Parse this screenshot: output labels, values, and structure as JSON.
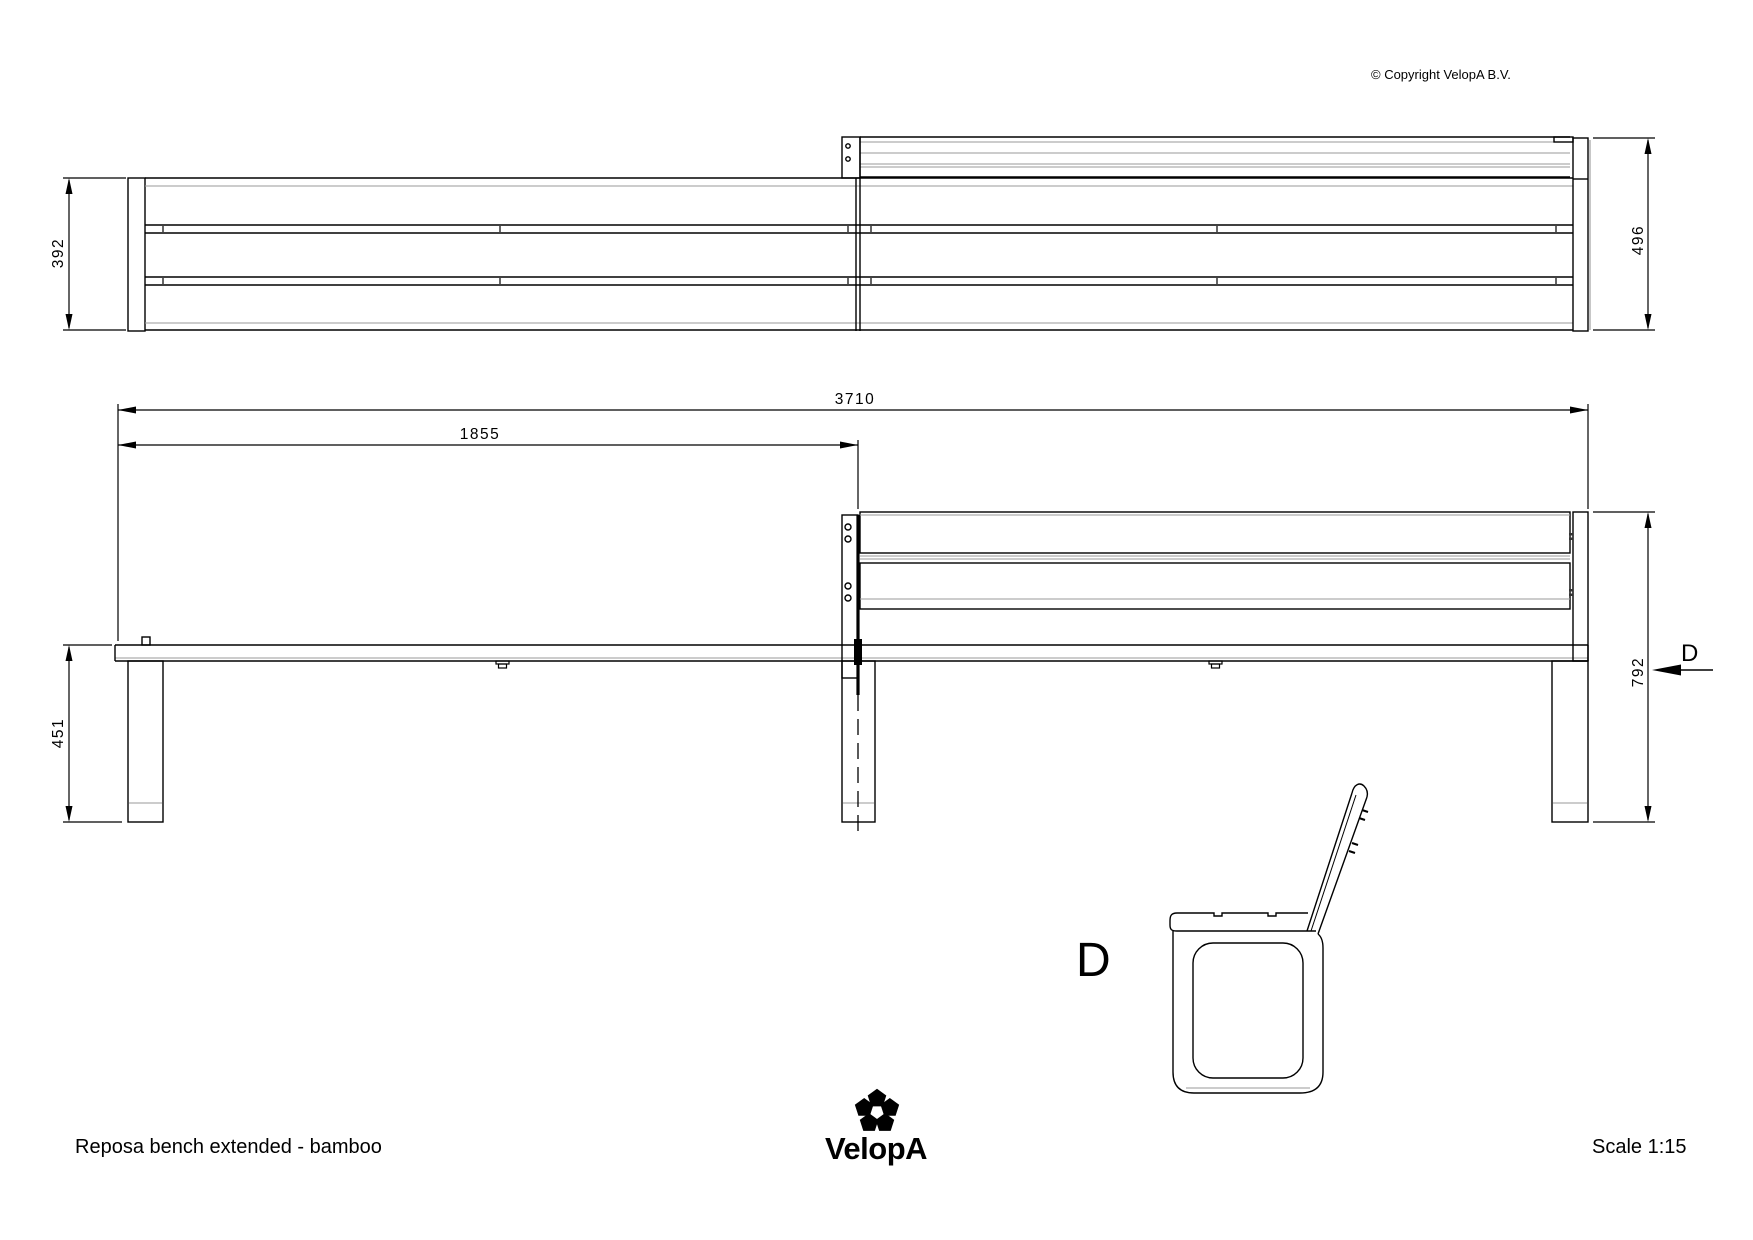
{
  "labels": {
    "drawing_title": "Reposa bench extended - bamboo",
    "scale": "Scale 1:15",
    "copyright": "©  Copyright VelopA B.V.",
    "brand": "VelopA",
    "section_view_label": "D",
    "section_cut_label": "D"
  },
  "dimensions_mm": {
    "seat_depth_backless": "392",
    "seat_depth_with_backrest": "496",
    "overall_length": "3710",
    "half_length": "1855",
    "seat_height": "451",
    "backrest_height": "792"
  },
  "colors": {
    "line": "#000000",
    "secondary_line": "#999999",
    "background": "#ffffff"
  }
}
